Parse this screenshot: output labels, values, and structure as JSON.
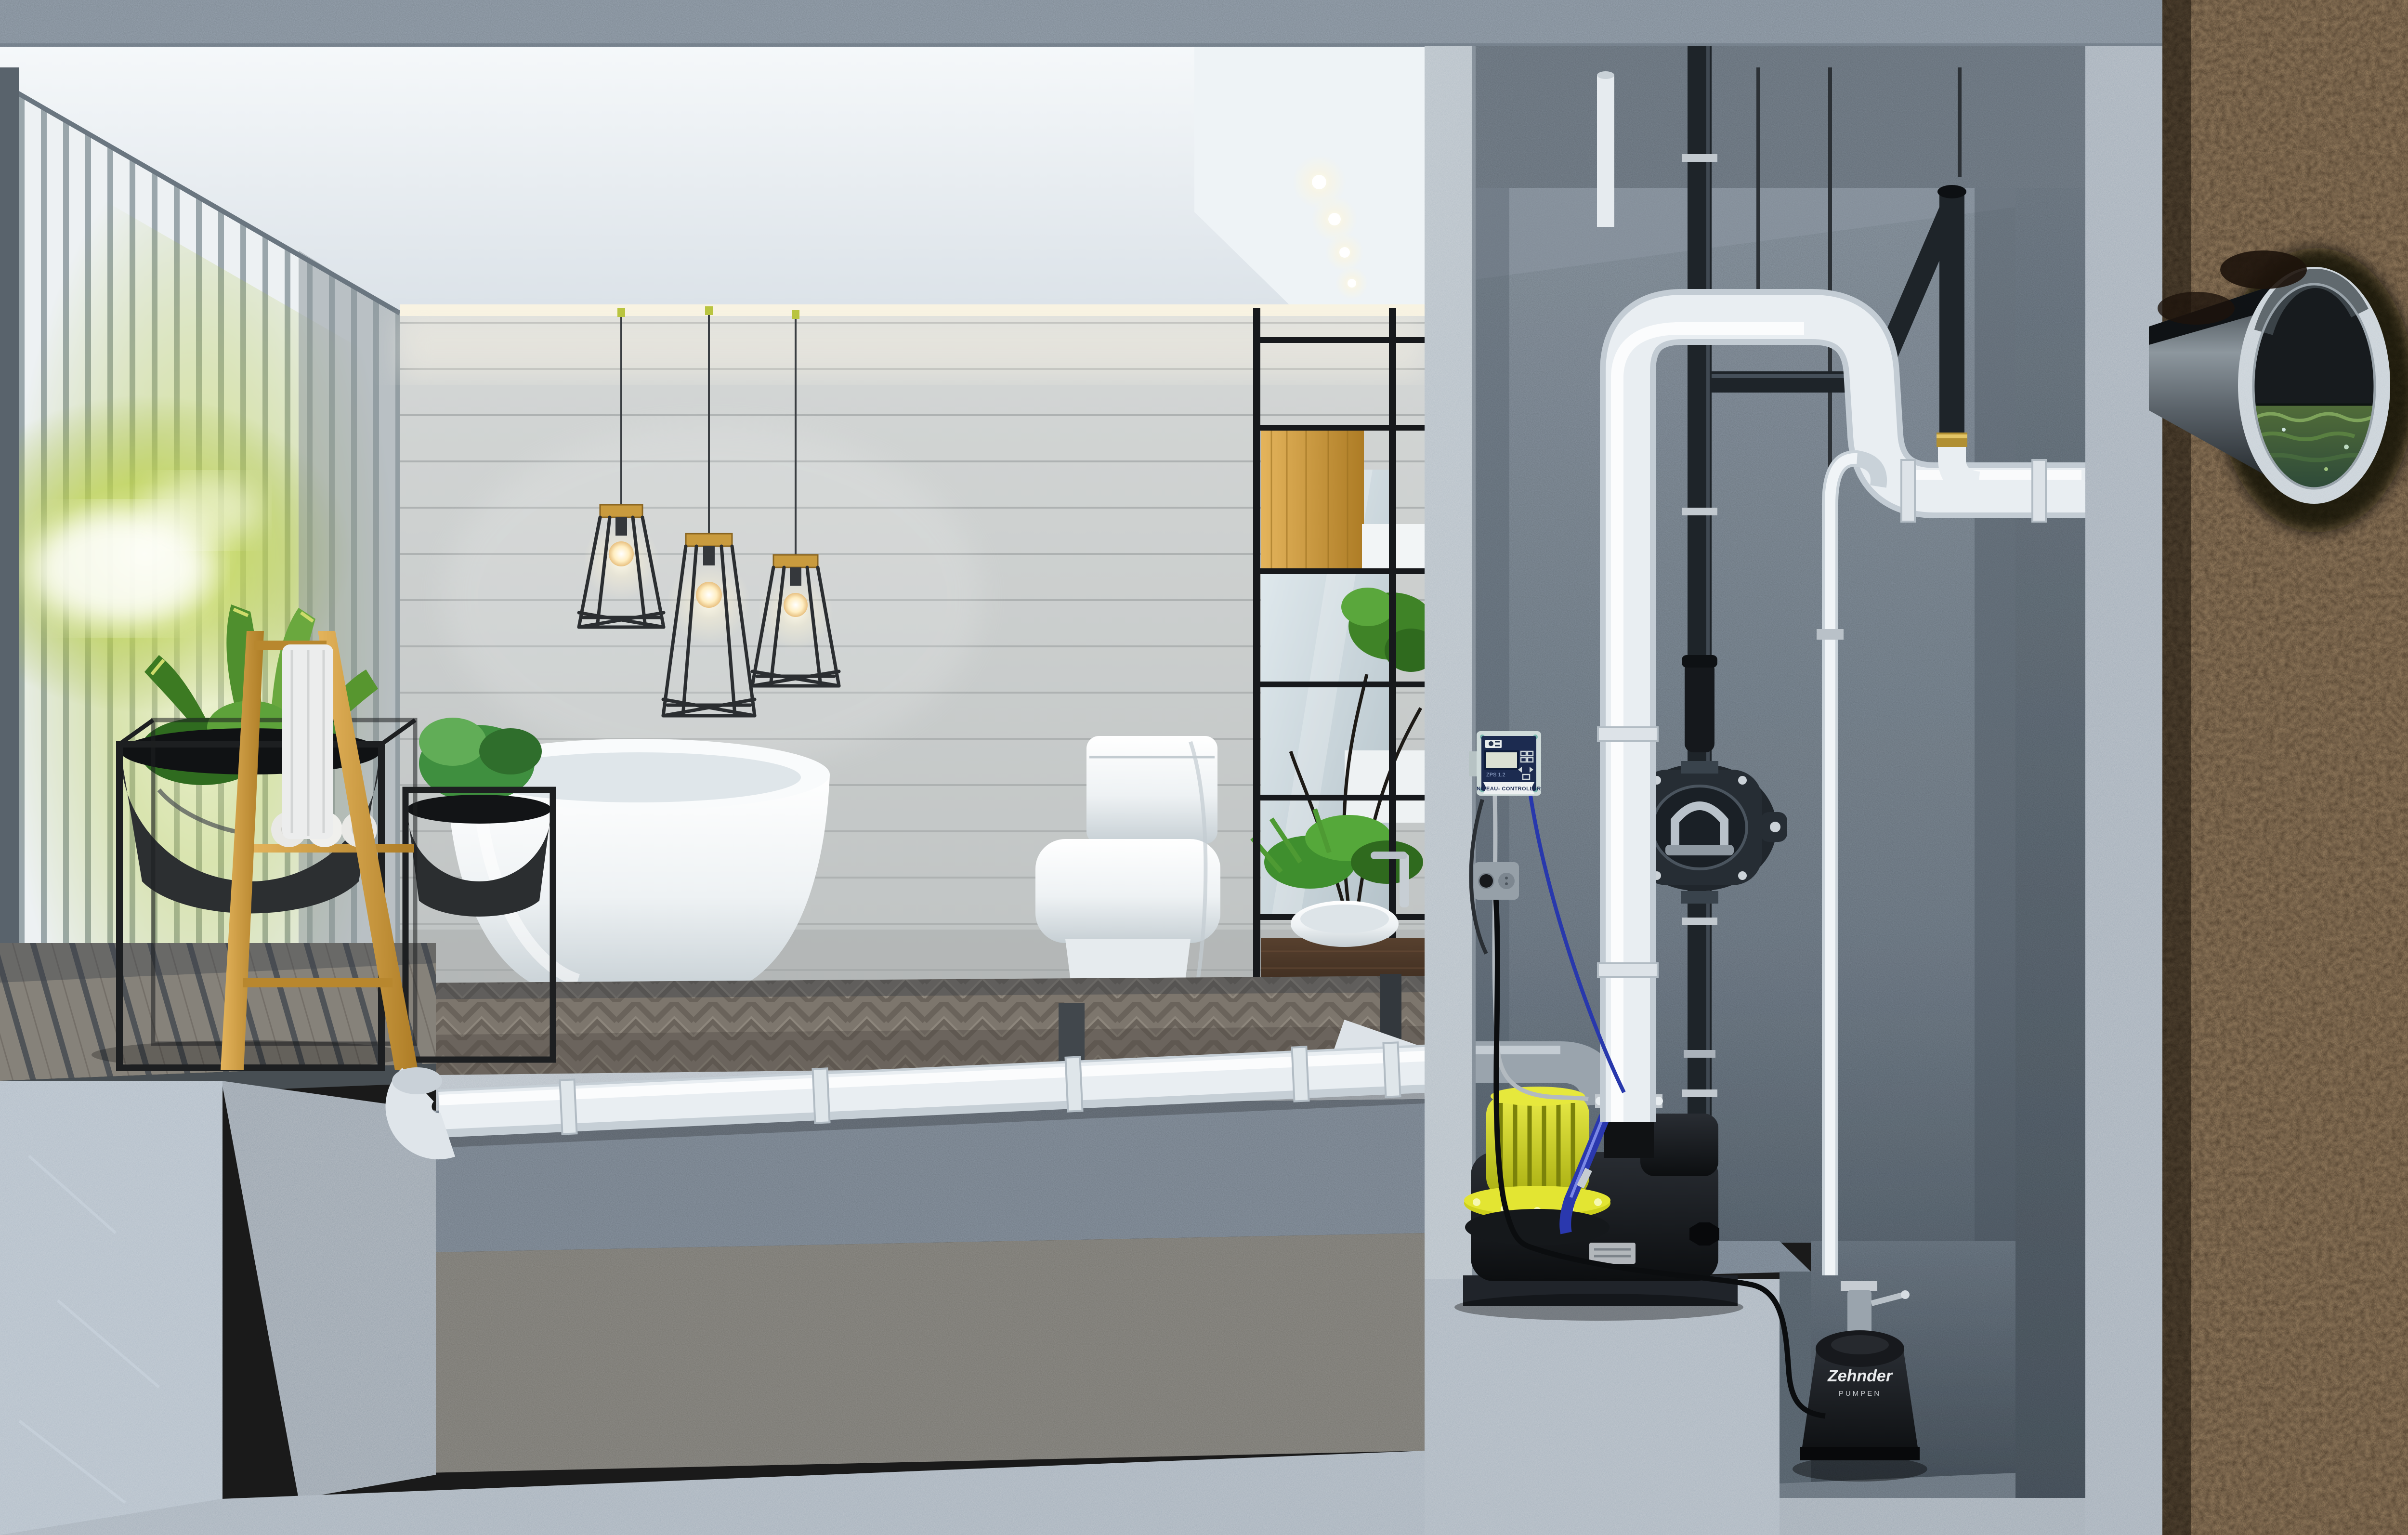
{
  "equipment": {
    "level_controller": {
      "title": "NIVEAU- CONTROLLER",
      "model": "ZPS 1.2"
    },
    "sump_pump": {
      "brand": "Zehnder",
      "brand_sub": "PUMPEN"
    }
  },
  "palette": {
    "pvc_white": "#e9eef2",
    "steel_black": "#1e2429",
    "motor_yellow": "#d9db22",
    "hose_blue": "#2a38ae",
    "controller_navy": "#1c2b50",
    "controller_case": "#cfdbda",
    "soil_brown": "#26190f",
    "water_green": "#3f5c33",
    "concrete_light": "#aeb9c3",
    "concrete_mid": "#7e8a96",
    "wood_amber": "#d2a03f",
    "plant_green": "#4e8f2e"
  }
}
